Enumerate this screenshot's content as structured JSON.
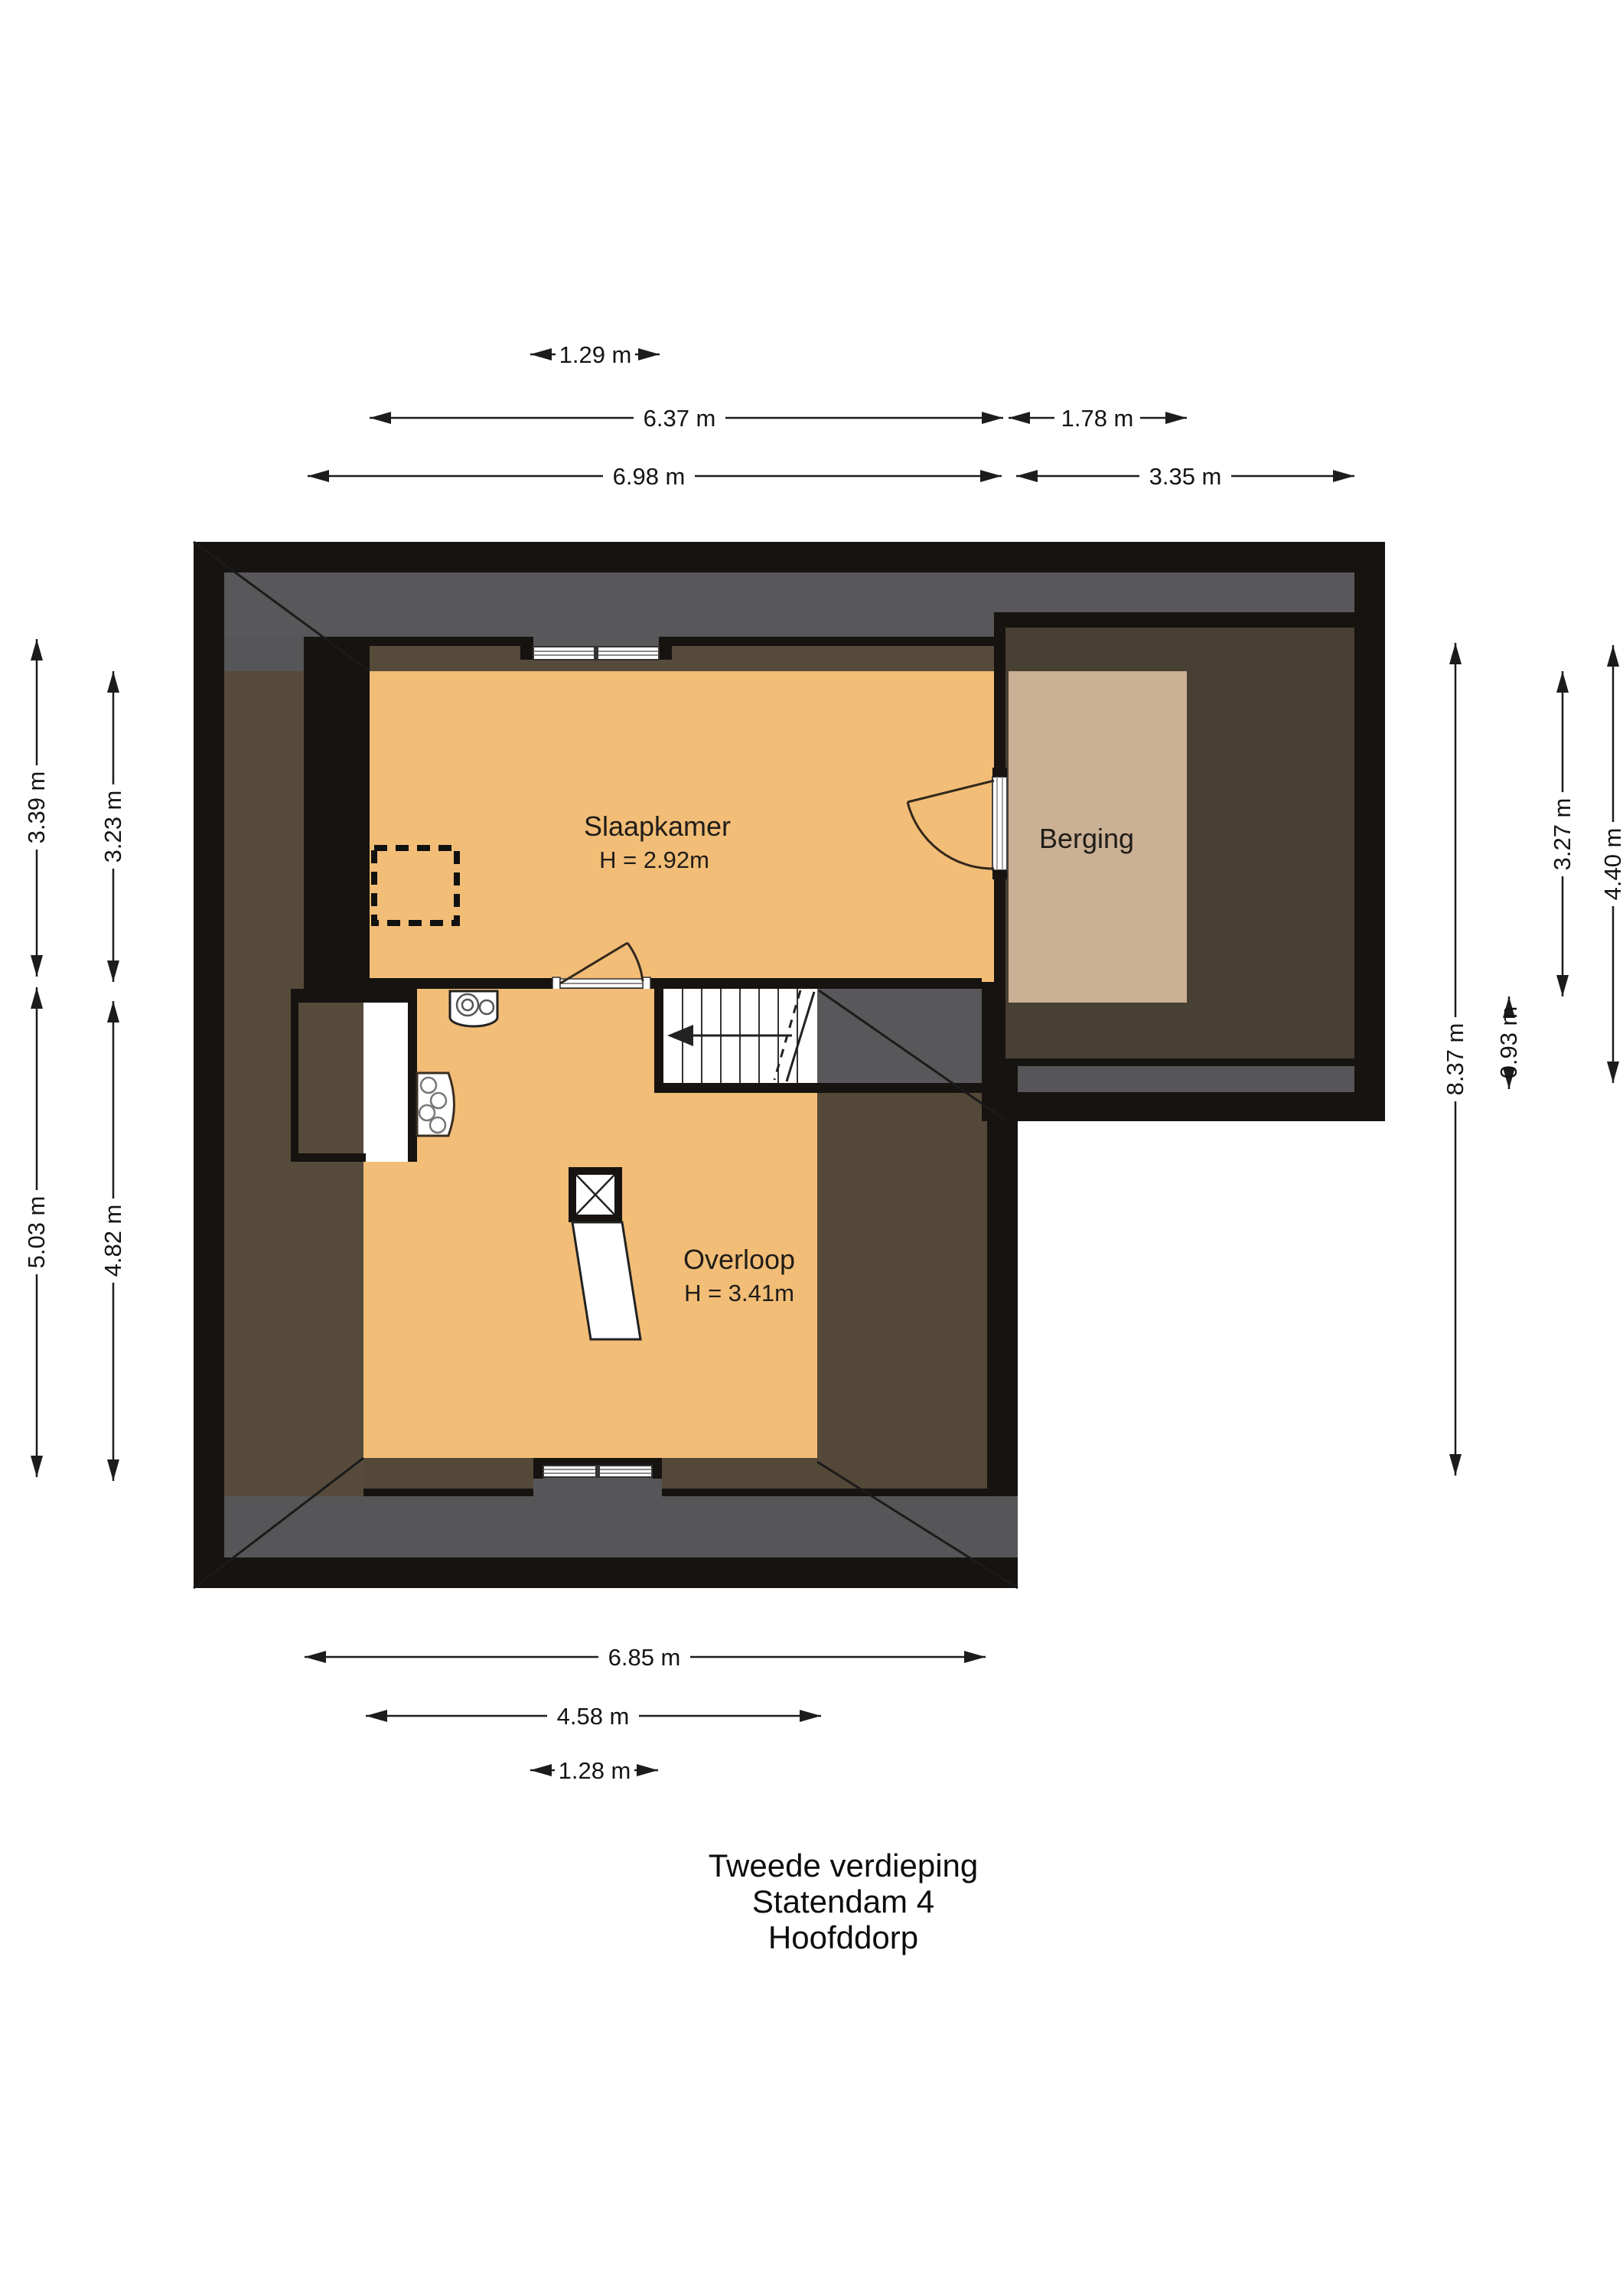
{
  "title": {
    "line1": "Tweede verdieping",
    "line2": "Statendam 4",
    "line3": "Hoofddorp"
  },
  "rooms": {
    "slaapkamer": {
      "name": "Slaapkamer",
      "ceiling_height": "H = 2.92m"
    },
    "overloop": {
      "name": "Overloop",
      "ceiling_height": "H = 3.41m"
    },
    "berging": {
      "name": "Berging"
    }
  },
  "dimensions": {
    "top_window_north": "1.29 m",
    "top_inner_main": "6.37 m",
    "top_inner_berging": "1.78 m",
    "top_outer_main": "6.98 m",
    "top_outer_extension": "3.35 m",
    "left_outer_upper": "3.39 m",
    "left_inner_upper": "3.23 m",
    "left_outer_lower": "5.03 m",
    "left_inner_lower": "4.82 m",
    "right_total": "8.37 m",
    "right_gap_south_berging": "0.93 m",
    "right_inner_berging": "3.27 m",
    "right_outer_extension": "4.40 m",
    "bottom_outer_main": "6.85 m",
    "bottom_inner_overloop": "4.58 m",
    "bottom_window_south": "1.28 m"
  },
  "colors": {
    "wall_black": "#161310",
    "roof_gray": "#58585a",
    "attic_brown": "#564a3a",
    "berging_brown": "#474033",
    "floor_orange": "#f2bd77",
    "floor_tan": "#cab094",
    "fixture_white": "#ffffff"
  }
}
